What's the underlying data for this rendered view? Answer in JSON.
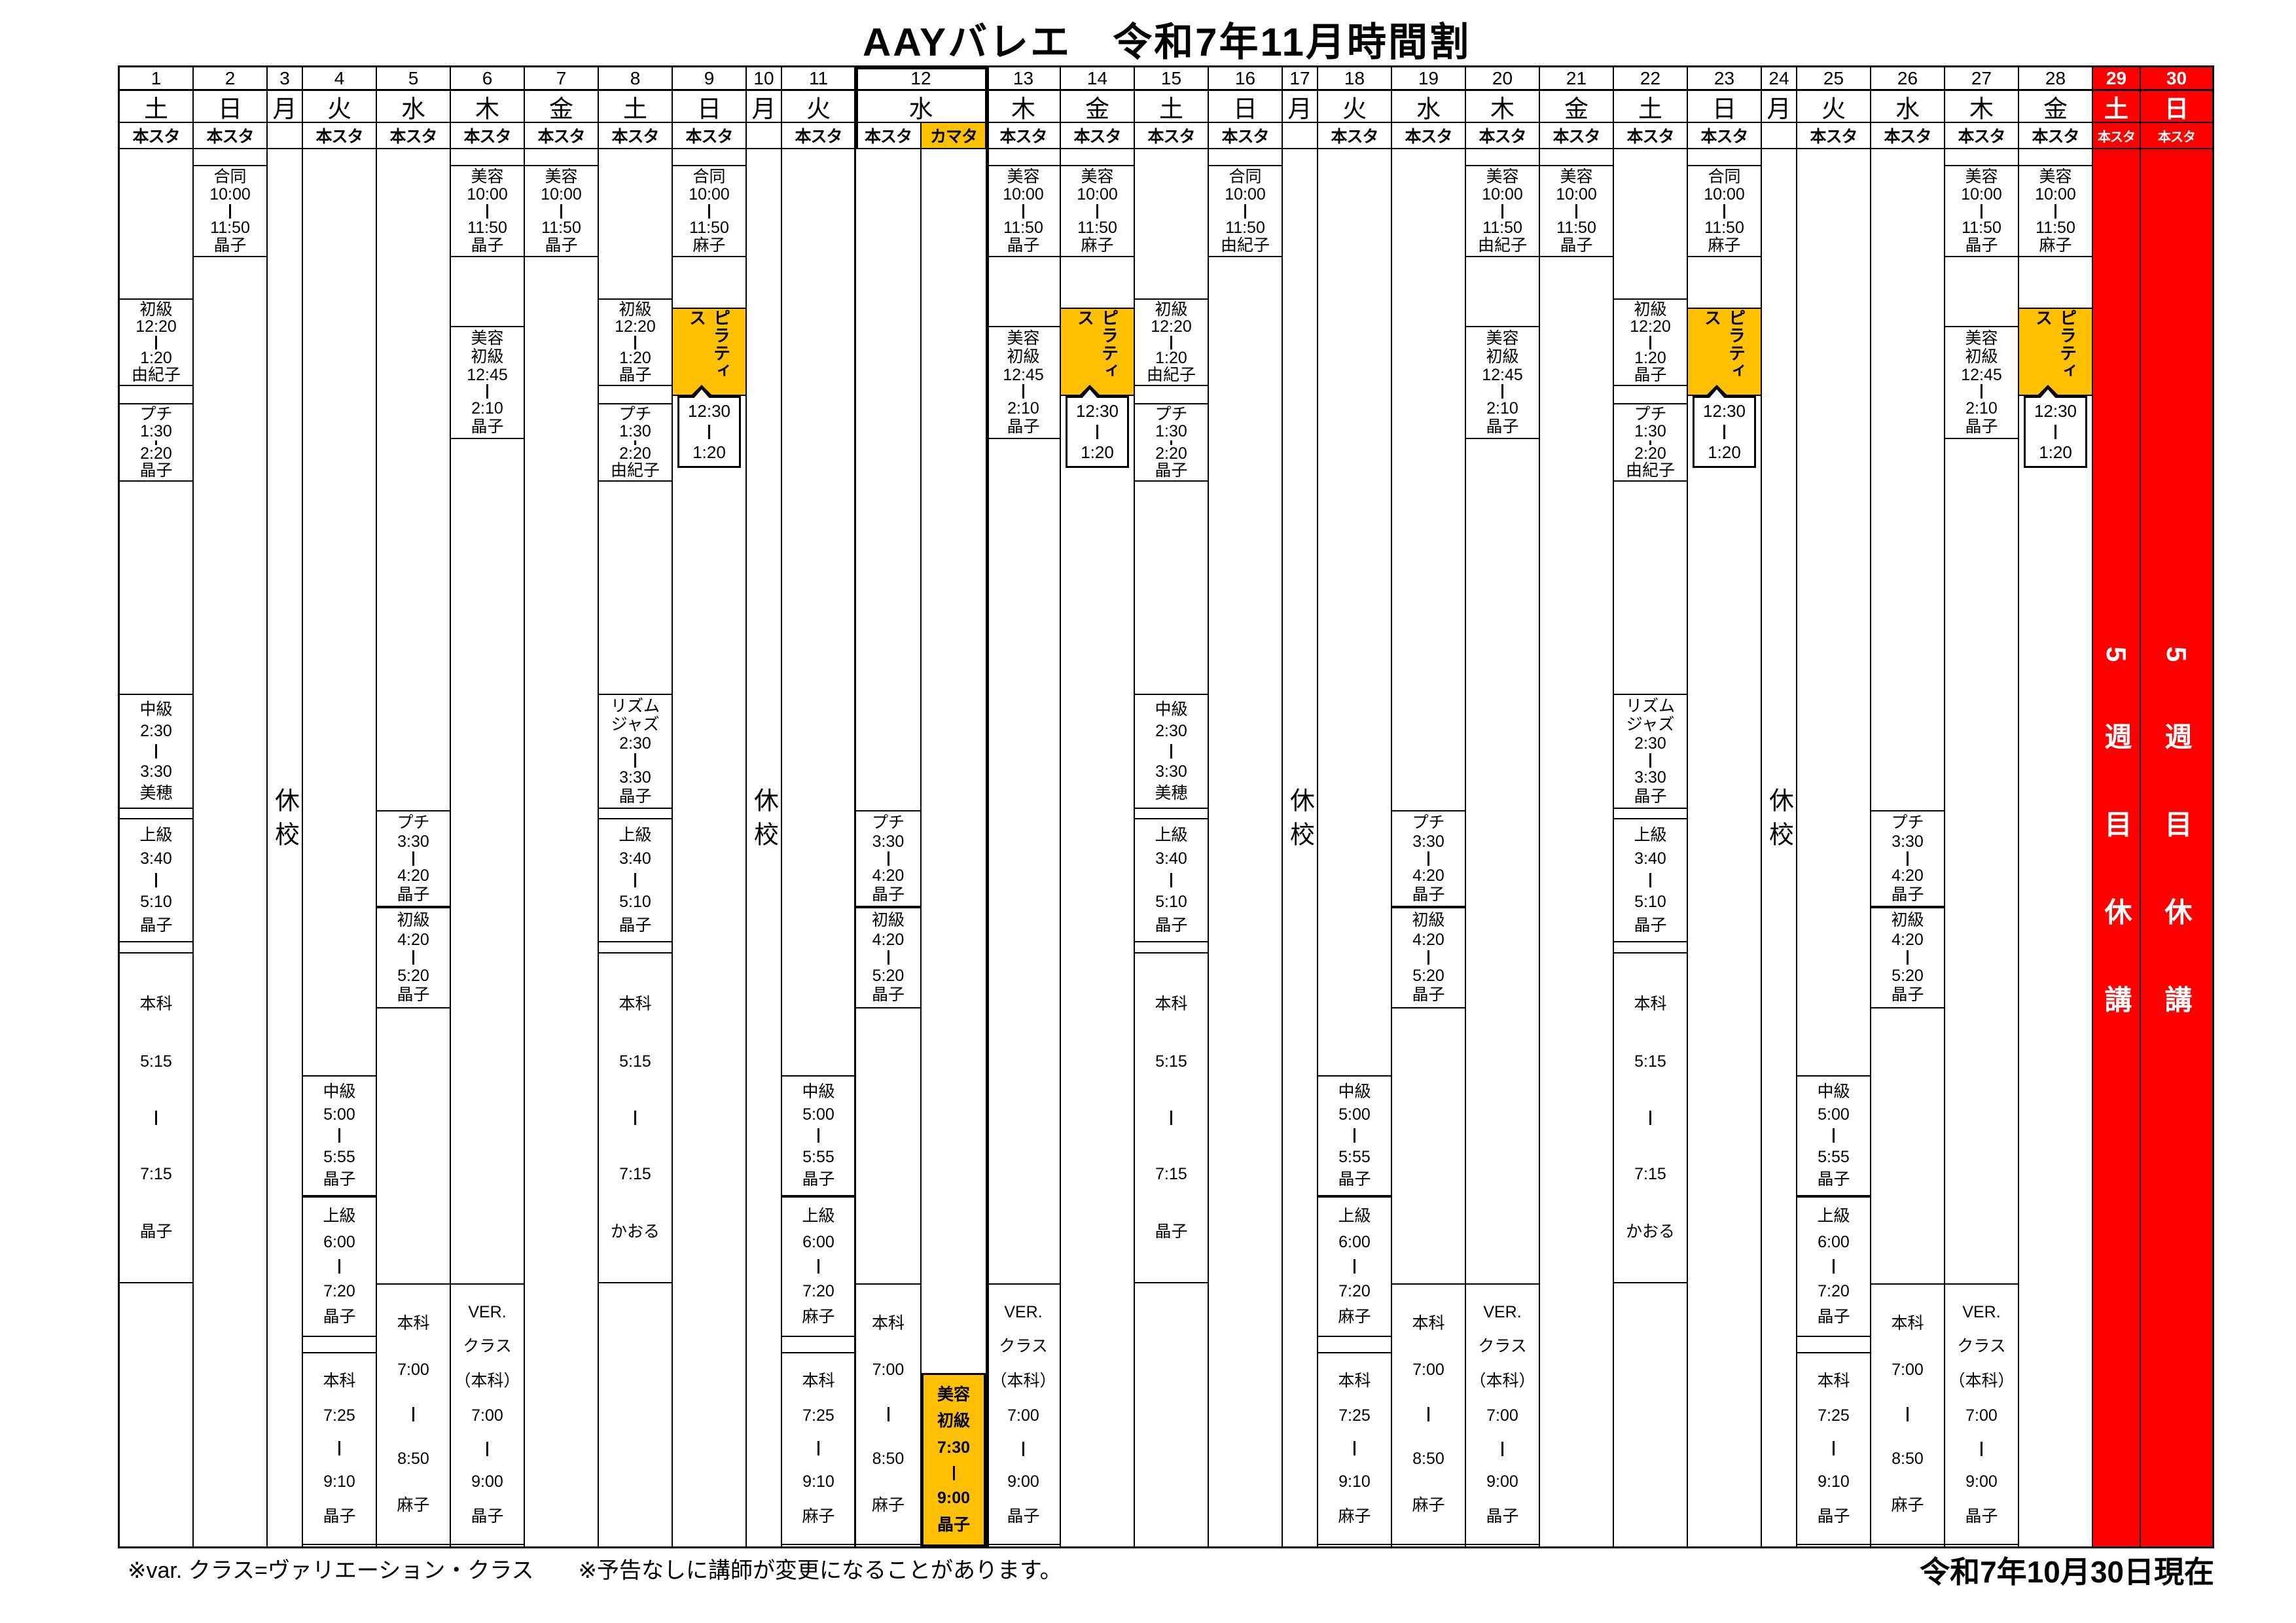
{
  "title": "AAYバレエ　令和7年11月時間割",
  "footer_notes": {
    "left": "※var. クラス=ヴァリエーション・クラス　　※予告なしに講師が変更になることがあります。",
    "right": "令和7年10月30日現在"
  },
  "labels": {
    "closed": "休校",
    "fifth_week": "5週目休講",
    "main_studio": "本スタ",
    "kamata_studio": "カマタ"
  },
  "colors": {
    "highlight_orange": "#FFC000",
    "holiday_red": "#FF0000"
  },
  "pilates": {
    "name": "ピラティス",
    "start": "12:30",
    "end": "1:20"
  },
  "days": [
    {
      "num": "1",
      "dow": "土",
      "studio": "本スタ",
      "classes": [
        {
          "slot": "shokyu1220",
          "name": "初級",
          "start": "12:20",
          "end": "1:20",
          "teacher": "由紀子"
        },
        {
          "slot": "petit130",
          "name": "プチ",
          "start": "1:30",
          "end": "2:20",
          "teacher": "晶子"
        },
        {
          "slot": "chukyu230",
          "name": "中級",
          "start": "2:30",
          "end": "3:30",
          "teacher": "美穂"
        },
        {
          "slot": "jokyu340",
          "name": "上級",
          "start": "3:40",
          "end": "5:10",
          "teacher": "晶子"
        },
        {
          "slot": "honka515",
          "name": "本科",
          "start": "5:15",
          "end": "7:15",
          "teacher": "晶子"
        }
      ]
    },
    {
      "num": "2",
      "dow": "日",
      "studio": "本スタ",
      "classes": [
        {
          "slot": "morning",
          "name": "合同",
          "start": "10:00",
          "end": "11:50",
          "teacher": "晶子"
        }
      ]
    },
    {
      "num": "3",
      "dow": "月",
      "studio": "",
      "closed": true,
      "classes": []
    },
    {
      "num": "4",
      "dow": "火",
      "studio": "本スタ",
      "classes": [
        {
          "slot": "chukyu500",
          "name": "中級",
          "start": "5:00",
          "end": "5:55",
          "teacher": "晶子"
        },
        {
          "slot": "jokyu600",
          "name": "上級",
          "start": "6:00",
          "end": "7:20",
          "teacher": "晶子"
        },
        {
          "slot": "honka725",
          "name": "本科",
          "start": "7:25",
          "end": "9:10",
          "teacher": "晶子"
        }
      ]
    },
    {
      "num": "5",
      "dow": "水",
      "studio": "本スタ",
      "classes": [
        {
          "slot": "petit330",
          "name": "プチ",
          "start": "3:30",
          "end": "4:20",
          "teacher": "晶子"
        },
        {
          "slot": "shokyu420",
          "name": "初級",
          "start": "4:20",
          "end": "5:20",
          "teacher": "晶子"
        },
        {
          "slot": "honka700",
          "name": "本科",
          "start": "7:00",
          "end": "8:50",
          "teacher": "麻子"
        }
      ]
    },
    {
      "num": "6",
      "dow": "木",
      "studio": "本スタ",
      "classes": [
        {
          "slot": "morning",
          "name": "美容",
          "start": "10:00",
          "end": "11:50",
          "teacher": "晶子"
        },
        {
          "slot": "biyoshokyu1245",
          "name": "美容／初級",
          "start": "12:45",
          "end": "2:10",
          "teacher": "晶子"
        },
        {
          "slot": "ver700",
          "name": "VER.／クラス／（本科）",
          "start": "7:00",
          "end": "9:00",
          "teacher": "晶子"
        }
      ]
    },
    {
      "num": "7",
      "dow": "金",
      "studio": "本スタ",
      "classes": [
        {
          "slot": "morning",
          "name": "美容",
          "start": "10:00",
          "end": "11:50",
          "teacher": "晶子"
        }
      ]
    },
    {
      "num": "8",
      "dow": "土",
      "studio": "本スタ",
      "classes": [
        {
          "slot": "shokyu1220",
          "name": "初級",
          "start": "12:20",
          "end": "1:20",
          "teacher": "晶子"
        },
        {
          "slot": "petit130",
          "name": "プチ",
          "start": "1:30",
          "end": "2:20",
          "teacher": "由紀子"
        },
        {
          "slot": "chukyu230",
          "name": "リズム／ジャズ",
          "start": "2:30",
          "end": "3:30",
          "teacher": "晶子"
        },
        {
          "slot": "jokyu340",
          "name": "上級",
          "start": "3:40",
          "end": "5:10",
          "teacher": "晶子"
        },
        {
          "slot": "honka515",
          "name": "本科",
          "start": "5:15",
          "end": "7:15",
          "teacher": "かおる"
        }
      ]
    },
    {
      "num": "9",
      "dow": "日",
      "studio": "本スタ",
      "classes": [
        {
          "slot": "morning",
          "name": "合同",
          "start": "10:00",
          "end": "11:50",
          "teacher": "麻子"
        },
        {
          "slot": "pilates",
          "name": "ピラティス"
        }
      ]
    },
    {
      "num": "10",
      "dow": "月",
      "studio": "",
      "closed": true,
      "classes": []
    },
    {
      "num": "11",
      "dow": "火",
      "studio": "本スタ",
      "classes": [
        {
          "slot": "chukyu500",
          "name": "中級",
          "start": "5:00",
          "end": "5:55",
          "teacher": "晶子"
        },
        {
          "slot": "jokyu600",
          "name": "上級",
          "start": "6:00",
          "end": "7:20",
          "teacher": "麻子"
        },
        {
          "slot": "honka725",
          "name": "本科",
          "start": "7:25",
          "end": "9:10",
          "teacher": "麻子"
        }
      ]
    },
    {
      "num": "12",
      "dow": "水",
      "studios": [
        "本スタ",
        "カマタ"
      ],
      "boxed": true,
      "classes": [
        {
          "slot": "petit330",
          "name": "プチ",
          "start": "3:30",
          "end": "4:20",
          "teacher": "晶子",
          "sub": 0
        },
        {
          "slot": "shokyu420",
          "name": "初級",
          "start": "4:20",
          "end": "5:20",
          "teacher": "晶子",
          "sub": 0
        },
        {
          "slot": "honka700",
          "name": "本科",
          "start": "7:00",
          "end": "8:50",
          "teacher": "麻子",
          "sub": 0
        },
        {
          "slot": "biyoshokyu730",
          "name": "美容／初級",
          "start": "7:30",
          "end": "9:00",
          "teacher": "晶子",
          "sub": 1,
          "orange": true
        }
      ]
    },
    {
      "num": "13",
      "dow": "木",
      "studio": "本スタ",
      "classes": [
        {
          "slot": "morning",
          "name": "美容",
          "start": "10:00",
          "end": "11:50",
          "teacher": "晶子"
        },
        {
          "slot": "biyoshokyu1245",
          "name": "美容／初級",
          "start": "12:45",
          "end": "2:10",
          "teacher": "晶子"
        },
        {
          "slot": "ver700",
          "name": "VER.／クラス／（本科）",
          "start": "7:00",
          "end": "9:00",
          "teacher": "晶子"
        }
      ]
    },
    {
      "num": "14",
      "dow": "金",
      "studio": "本スタ",
      "classes": [
        {
          "slot": "morning",
          "name": "美容",
          "start": "10:00",
          "end": "11:50",
          "teacher": "麻子"
        },
        {
          "slot": "pilates",
          "name": "ピラティス"
        }
      ]
    },
    {
      "num": "15",
      "dow": "土",
      "studio": "本スタ",
      "classes": [
        {
          "slot": "shokyu1220",
          "name": "初級",
          "start": "12:20",
          "end": "1:20",
          "teacher": "由紀子"
        },
        {
          "slot": "petit130",
          "name": "プチ",
          "start": "1:30",
          "end": "2:20",
          "teacher": "晶子"
        },
        {
          "slot": "chukyu230",
          "name": "中級",
          "start": "2:30",
          "end": "3:30",
          "teacher": "美穂"
        },
        {
          "slot": "jokyu340",
          "name": "上級",
          "start": "3:40",
          "end": "5:10",
          "teacher": "晶子"
        },
        {
          "slot": "honka515",
          "name": "本科",
          "start": "5:15",
          "end": "7:15",
          "teacher": "晶子"
        }
      ]
    },
    {
      "num": "16",
      "dow": "日",
      "studio": "本スタ",
      "classes": [
        {
          "slot": "morning",
          "name": "合同",
          "start": "10:00",
          "end": "11:50",
          "teacher": "由紀子"
        }
      ]
    },
    {
      "num": "17",
      "dow": "月",
      "studio": "",
      "closed": true,
      "classes": []
    },
    {
      "num": "18",
      "dow": "火",
      "studio": "本スタ",
      "classes": [
        {
          "slot": "chukyu500",
          "name": "中級",
          "start": "5:00",
          "end": "5:55",
          "teacher": "晶子"
        },
        {
          "slot": "jokyu600",
          "name": "上級",
          "start": "6:00",
          "end": "7:20",
          "teacher": "麻子"
        },
        {
          "slot": "honka725",
          "name": "本科",
          "start": "7:25",
          "end": "9:10",
          "teacher": "麻子"
        }
      ]
    },
    {
      "num": "19",
      "dow": "水",
      "studio": "本スタ",
      "classes": [
        {
          "slot": "petit330",
          "name": "プチ",
          "start": "3:30",
          "end": "4:20",
          "teacher": "晶子"
        },
        {
          "slot": "shokyu420",
          "name": "初級",
          "start": "4:20",
          "end": "5:20",
          "teacher": "晶子"
        },
        {
          "slot": "honka700",
          "name": "本科",
          "start": "7:00",
          "end": "8:50",
          "teacher": "麻子"
        }
      ]
    },
    {
      "num": "20",
      "dow": "木",
      "studio": "本スタ",
      "classes": [
        {
          "slot": "morning",
          "name": "美容",
          "start": "10:00",
          "end": "11:50",
          "teacher": "由紀子"
        },
        {
          "slot": "biyoshokyu1245",
          "name": "美容／初級",
          "start": "12:45",
          "end": "2:10",
          "teacher": "晶子"
        },
        {
          "slot": "ver700",
          "name": "VER.／クラス／（本科）",
          "start": "7:00",
          "end": "9:00",
          "teacher": "晶子"
        }
      ]
    },
    {
      "num": "21",
      "dow": "金",
      "studio": "本スタ",
      "classes": [
        {
          "slot": "morning",
          "name": "美容",
          "start": "10:00",
          "end": "11:50",
          "teacher": "晶子"
        }
      ]
    },
    {
      "num": "22",
      "dow": "土",
      "studio": "本スタ",
      "classes": [
        {
          "slot": "shokyu1220",
          "name": "初級",
          "start": "12:20",
          "end": "1:20",
          "teacher": "晶子"
        },
        {
          "slot": "petit130",
          "name": "プチ",
          "start": "1:30",
          "end": "2:20",
          "teacher": "由紀子"
        },
        {
          "slot": "chukyu230",
          "name": "リズム／ジャズ",
          "start": "2:30",
          "end": "3:30",
          "teacher": "晶子"
        },
        {
          "slot": "jokyu340",
          "name": "上級",
          "start": "3:40",
          "end": "5:10",
          "teacher": "晶子"
        },
        {
          "slot": "honka515",
          "name": "本科",
          "start": "5:15",
          "end": "7:15",
          "teacher": "かおる"
        }
      ]
    },
    {
      "num": "23",
      "dow": "日",
      "studio": "本スタ",
      "classes": [
        {
          "slot": "morning",
          "name": "合同",
          "start": "10:00",
          "end": "11:50",
          "teacher": "麻子"
        },
        {
          "slot": "pilates",
          "name": "ピラティス"
        }
      ]
    },
    {
      "num": "24",
      "dow": "月",
      "studio": "",
      "closed": true,
      "classes": []
    },
    {
      "num": "25",
      "dow": "火",
      "studio": "本スタ",
      "classes": [
        {
          "slot": "chukyu500",
          "name": "中級",
          "start": "5:00",
          "end": "5:55",
          "teacher": "晶子"
        },
        {
          "slot": "jokyu600",
          "name": "上級",
          "start": "6:00",
          "end": "7:20",
          "teacher": "晶子"
        },
        {
          "slot": "honka725",
          "name": "本科",
          "start": "7:25",
          "end": "9:10",
          "teacher": "晶子"
        }
      ]
    },
    {
      "num": "26",
      "dow": "水",
      "studio": "本スタ",
      "classes": [
        {
          "slot": "petit330",
          "name": "プチ",
          "start": "3:30",
          "end": "4:20",
          "teacher": "晶子"
        },
        {
          "slot": "shokyu420",
          "name": "初級",
          "start": "4:20",
          "end": "5:20",
          "teacher": "晶子"
        },
        {
          "slot": "honka700",
          "name": "本科",
          "start": "7:00",
          "end": "8:50",
          "teacher": "麻子"
        }
      ]
    },
    {
      "num": "27",
      "dow": "木",
      "studio": "本スタ",
      "classes": [
        {
          "slot": "morning",
          "name": "美容",
          "start": "10:00",
          "end": "11:50",
          "teacher": "晶子"
        },
        {
          "slot": "biyoshokyu1245",
          "name": "美容／初級",
          "start": "12:45",
          "end": "2:10",
          "teacher": "晶子"
        },
        {
          "slot": "ver700",
          "name": "VER.／クラス／（本科）",
          "start": "7:00",
          "end": "9:00",
          "teacher": "晶子"
        }
      ]
    },
    {
      "num": "28",
      "dow": "金",
      "studio": "本スタ",
      "classes": [
        {
          "slot": "morning",
          "name": "美容",
          "start": "10:00",
          "end": "11:50",
          "teacher": "麻子"
        },
        {
          "slot": "pilates",
          "name": "ピラティス"
        }
      ]
    },
    {
      "num": "29",
      "dow": "土",
      "studio": "本スタ",
      "red": true,
      "classes": []
    },
    {
      "num": "30",
      "dow": "日",
      "studio": "本スタ",
      "red": true,
      "classes": []
    }
  ]
}
